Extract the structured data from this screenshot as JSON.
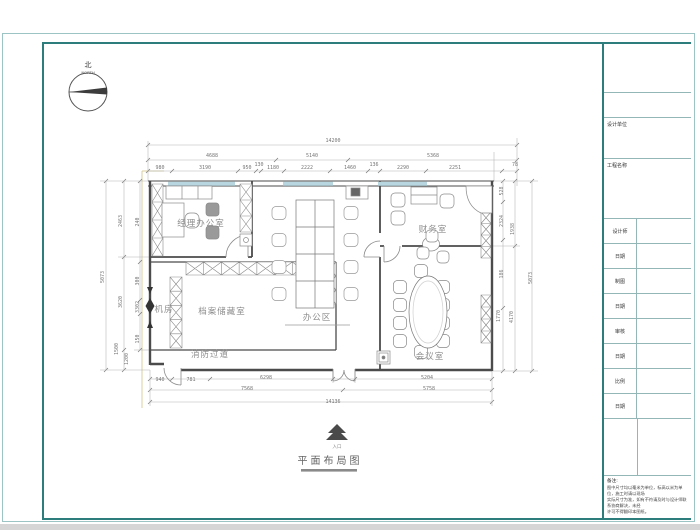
{
  "north": {
    "char": "北",
    "word": "NORTH"
  },
  "plan_title": "平面布局图",
  "entrance_label": "入口",
  "rooms": [
    {
      "name": "经理办公室",
      "x": 201,
      "y": 226
    },
    {
      "name": "财务室",
      "x": 433,
      "y": 232
    },
    {
      "name": "办公区",
      "x": 317,
      "y": 320
    },
    {
      "name": "档案储藏室",
      "x": 222,
      "y": 314
    },
    {
      "name": "机房",
      "x": 164,
      "y": 312
    },
    {
      "name": "消防过道",
      "x": 210,
      "y": 357
    },
    {
      "name": "会议室",
      "x": 430,
      "y": 359
    }
  ],
  "dims": [
    {
      "t": "14200",
      "x": 333,
      "y": 142
    },
    {
      "t": "4688",
      "x": 212,
      "y": 157
    },
    {
      "t": "5140",
      "x": 312,
      "y": 157
    },
    {
      "t": "5368",
      "x": 433,
      "y": 157
    },
    {
      "t": "980",
      "x": 160,
      "y": 169
    },
    {
      "t": "3190",
      "x": 205,
      "y": 169
    },
    {
      "t": "950",
      "x": 247,
      "y": 169
    },
    {
      "t": "130",
      "x": 259,
      "y": 166
    },
    {
      "t": "1180",
      "x": 273,
      "y": 169
    },
    {
      "t": "2222",
      "x": 307,
      "y": 169
    },
    {
      "t": "1460",
      "x": 350,
      "y": 169
    },
    {
      "t": "136",
      "x": 374,
      "y": 166
    },
    {
      "t": "2290",
      "x": 403,
      "y": 169
    },
    {
      "t": "2251",
      "x": 455,
      "y": 169
    },
    {
      "t": "78",
      "x": 515,
      "y": 166
    },
    {
      "t": "5073",
      "x": 104,
      "y": 277,
      "r": 1
    },
    {
      "t": "2463",
      "x": 122,
      "y": 221,
      "r": 1
    },
    {
      "t": "3620",
      "x": 122,
      "y": 302,
      "r": 1
    },
    {
      "t": "1500",
      "x": 118,
      "y": 349,
      "r": 1
    },
    {
      "t": "1200",
      "x": 128,
      "y": 359,
      "r": 1
    },
    {
      "t": "240",
      "x": 139,
      "y": 222,
      "r": 1
    },
    {
      "t": "300",
      "x": 139,
      "y": 281,
      "r": 1
    },
    {
      "t": "3302",
      "x": 139,
      "y": 307,
      "r": 1
    },
    {
      "t": "150",
      "x": 139,
      "y": 339,
      "r": 1
    },
    {
      "t": "528",
      "x": 503,
      "y": 191,
      "r": 1
    },
    {
      "t": "2324",
      "x": 503,
      "y": 221,
      "r": 1
    },
    {
      "t": "1938",
      "x": 514,
      "y": 229,
      "r": 1
    },
    {
      "t": "186",
      "x": 503,
      "y": 274,
      "r": 1
    },
    {
      "t": "1770",
      "x": 500,
      "y": 316,
      "r": 1
    },
    {
      "t": "4170",
      "x": 513,
      "y": 317,
      "r": 1
    },
    {
      "t": "5073",
      "x": 532,
      "y": 278,
      "r": 1
    },
    {
      "t": "940",
      "x": 160,
      "y": 381
    },
    {
      "t": "781",
      "x": 191,
      "y": 381
    },
    {
      "t": "6298",
      "x": 266,
      "y": 379
    },
    {
      "t": "5204",
      "x": 427,
      "y": 379
    },
    {
      "t": "7568",
      "x": 247,
      "y": 390
    },
    {
      "t": "5758",
      "x": 429,
      "y": 390
    },
    {
      "t": "14136",
      "x": 333,
      "y": 403
    }
  ],
  "titleblock": {
    "company_label": "设计单位",
    "project_label": "工程名称",
    "rows": [
      {
        "label": "设计师"
      },
      {
        "label": "日期"
      },
      {
        "label": "制图"
      },
      {
        "label": "日期"
      },
      {
        "label": "审核"
      },
      {
        "label": "日期"
      },
      {
        "label": "比例"
      },
      {
        "label": "日期"
      }
    ],
    "notes_title": "备注:",
    "notes": [
      "图中尺寸均以毫米为单位，标高以米为单位，施工时请以现场",
      "实际尺寸为准，如有不符请及时与设计师联系协商解决，未经",
      "许可不得翻印本图纸。"
    ]
  },
  "colors": {
    "frame_teal": "#2e7d7d",
    "window_blue": "#b7d6e0",
    "wall_gray": "#4b4b4b"
  }
}
